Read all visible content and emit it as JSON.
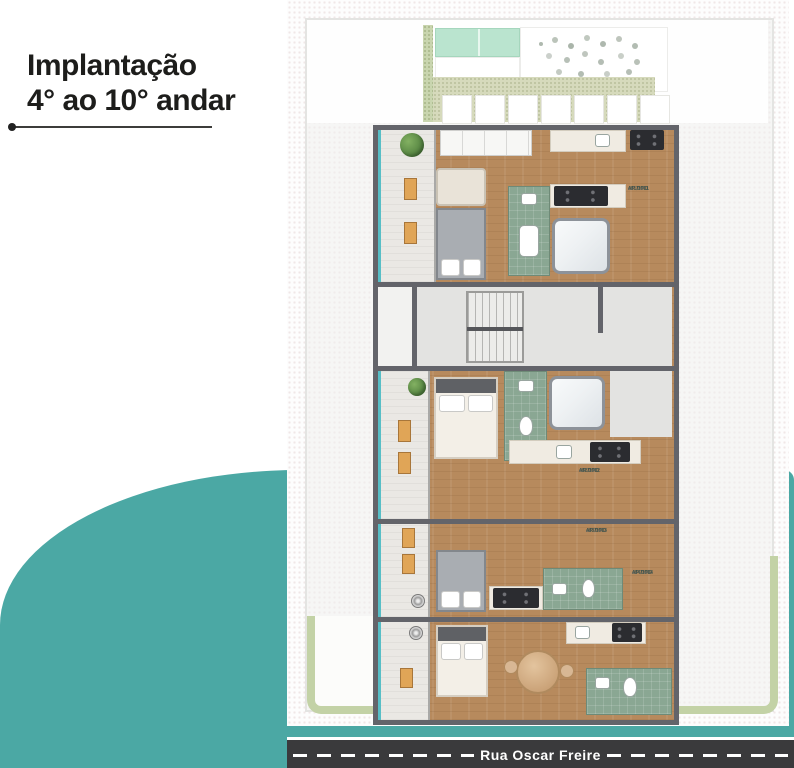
{
  "title": {
    "line1": "Implantação",
    "line2": "4° ao 10° andar"
  },
  "road": {
    "name": "Rua Oscar Freire"
  },
  "apartments": [
    {
      "type_label": "AP TIPO",
      "unit": "401/1001",
      "area": "A=··,··m²"
    },
    {
      "type_label": "AP TIPO",
      "unit": "402/1002",
      "area": "A=··,··m²"
    },
    {
      "type_label": "AP TIPO",
      "unit": "403/1003",
      "area": "A=··,··m²"
    },
    {
      "type_label": "AP TIPO",
      "unit": "404/1004",
      "area": "A=··,··m²"
    }
  ],
  "colors": {
    "accent_teal": "#4BA8A4",
    "road_asphalt": "#3A3A3C",
    "wood_floor": "#B78A5D",
    "bathroom_green": "#8AA793",
    "mint_panel": "#BAE4CF",
    "garden_green": "#C3D2A6",
    "wall_gray": "#63646A",
    "title_text": "#1D1D1B"
  }
}
